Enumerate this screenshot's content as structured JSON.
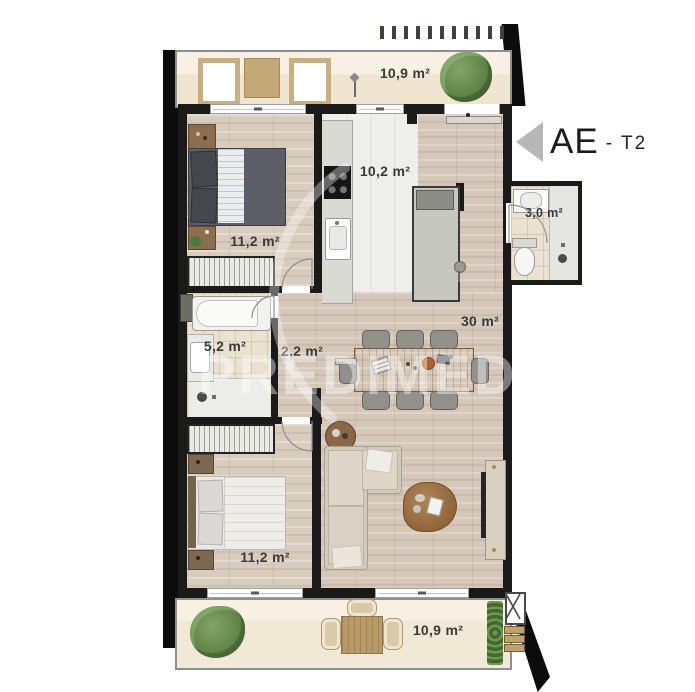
{
  "header": {
    "unit_code": "AE",
    "unit_type": "- T2"
  },
  "watermark": "PREDIMED",
  "areas": {
    "balcony_top": "10,9 m²",
    "bedroom_1": "11,2 m²",
    "kitchen": "10,2 m²",
    "bathroom_small": "3,0 m²",
    "bathroom_main": "5,2 m²",
    "hall": "2,2 m²",
    "living_room": "30 m²",
    "bedroom_2": "11,2 m²",
    "balcony_bottom": "10,9 m²"
  },
  "colors": {
    "wall": "#1a1a18",
    "wood_floor": "#d8ccbe",
    "kitchen_floor": "#eeeeec",
    "bathroom_floor": "#eae2d0",
    "balcony_floor": "#f3ead9",
    "arrow": "#b7b7b7",
    "greenery": "#5d8046"
  }
}
